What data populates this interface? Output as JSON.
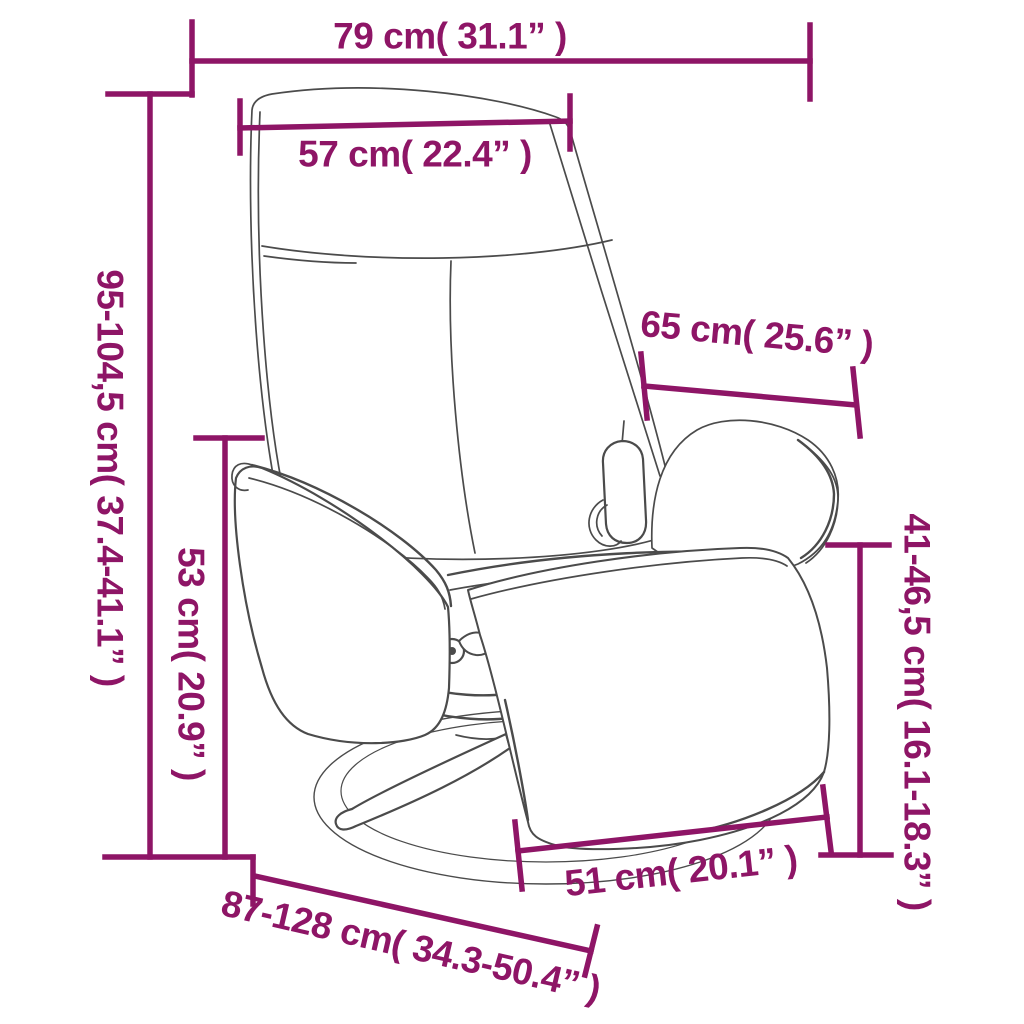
{
  "diagram": {
    "type": "product-dimension-diagram",
    "subject": "recliner chair with footrest and swivel base",
    "accent_color": "#8E1566",
    "outline_color": "#4b4b4b",
    "background_color": "#ffffff",
    "labels": {
      "overall_width": "79 cm( 31.1” )",
      "backrest_width": "57 cm( 22.4” )",
      "overall_height": "95-104,5 cm( 37.4-41.1” )",
      "backrest_depth": "65 cm( 25.6” )",
      "armrest_height": "53 cm( 20.9” )",
      "footrest_height": "41-46,5 cm( 16.1-18.3” )",
      "seat_width": "51 cm( 20.1” )",
      "overall_depth": "87-128 cm( 34.3-50.4” )"
    }
  }
}
